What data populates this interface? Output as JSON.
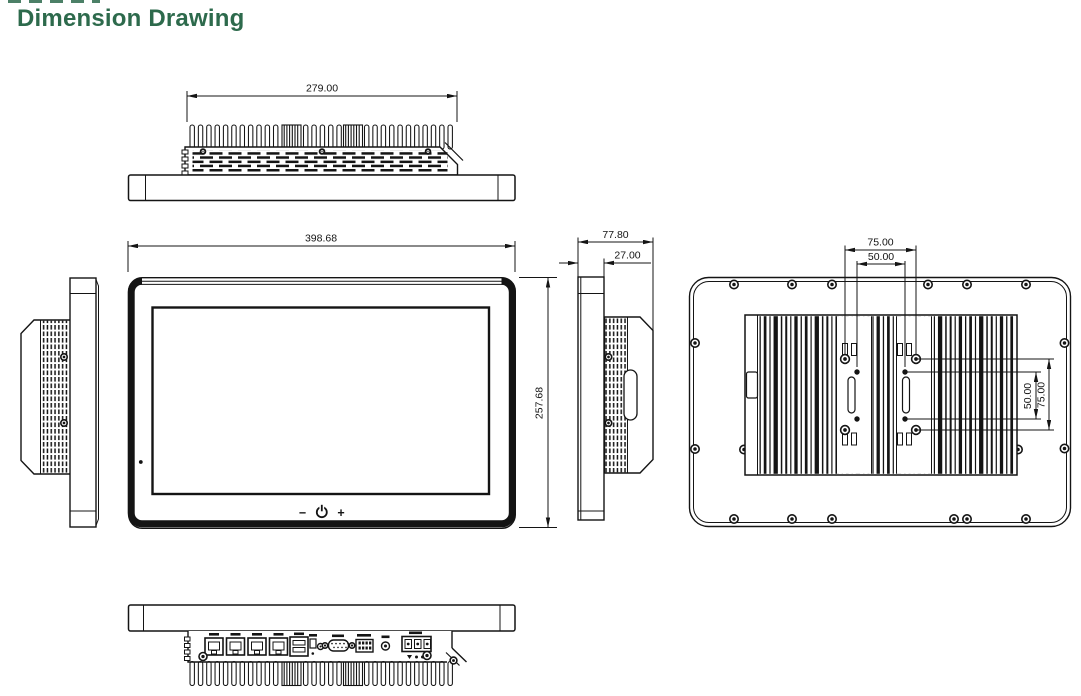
{
  "title": "Dimension Drawing",
  "colors": {
    "title_green": "#2d6a4c",
    "line": "#141414",
    "background": "#ffffff"
  },
  "dimensions": {
    "top_width": "279.00",
    "front_width": "398.68",
    "front_height": "257.68",
    "side_depth_total": "77.80",
    "side_depth_panel": "27.00",
    "vesa_horizontal_outer": "75.00",
    "vesa_horizontal_inner": "50.00",
    "vesa_vertical_inner": "50.00",
    "vesa_vertical_outer": "75.00"
  },
  "front_controls": {
    "brightness_down": "−",
    "brightness_up": "+"
  }
}
